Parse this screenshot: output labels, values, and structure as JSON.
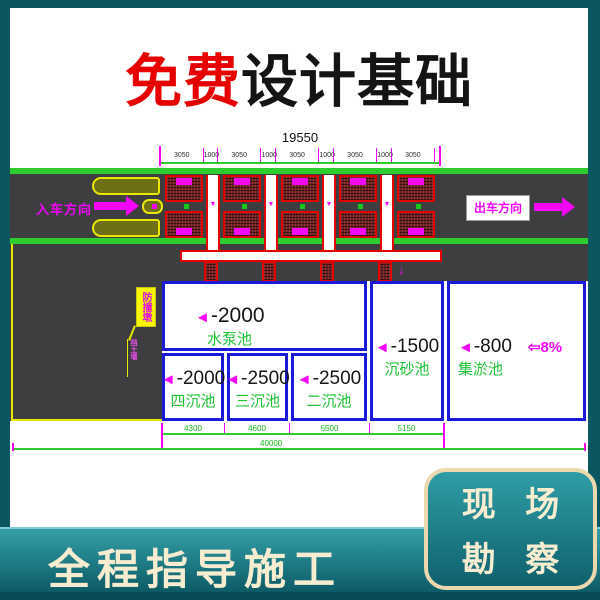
{
  "title": {
    "highlight": "免费",
    "rest": "设计基础"
  },
  "drawing": {
    "dims_top": {
      "total": "19550",
      "segments": [
        "3050",
        "1000",
        "3050",
        "1000",
        "3050",
        "1000",
        "3050",
        "1000",
        "3050"
      ]
    },
    "road": {
      "entry_label": "入车方向",
      "exit_label": "出车方向"
    },
    "annotations": {
      "island_label": "防撞墩",
      "wall_label": "挡土墙"
    },
    "tanks": [
      {
        "elev": "-2000",
        "name": "水泵池"
      },
      {
        "elev": "-1500",
        "name": "沉砂池"
      },
      {
        "elev": "-800",
        "name": "集淤池",
        "slope": "⇦8%"
      },
      {
        "elev": "-2000",
        "name": "四沉池"
      },
      {
        "elev": "-2500",
        "name": "三沉池"
      },
      {
        "elev": "-2500",
        "name": "二沉池"
      }
    ],
    "dims_bottom": {
      "segments": [
        "4300",
        "4600",
        "5500",
        "5150"
      ],
      "total": "40000"
    }
  },
  "icons": {
    "elevation_marker": "◄",
    "flow_down": "▼",
    "inlet_arrow": "↓"
  },
  "footer": {
    "banner_label": "全程指导施工",
    "badge_line1": "现 场",
    "badge_line2": "勘 察"
  },
  "colors": {
    "teal_background": "#0B5661",
    "cream_text": "#F6ECD0",
    "title_red": "#E60000",
    "cad_green": "#1DC333",
    "cad_magenta": "#F505F5",
    "tank_blue": "#1A1AD8",
    "road_gray": "#3E3E41",
    "lane_green": "#2ECC2E"
  }
}
